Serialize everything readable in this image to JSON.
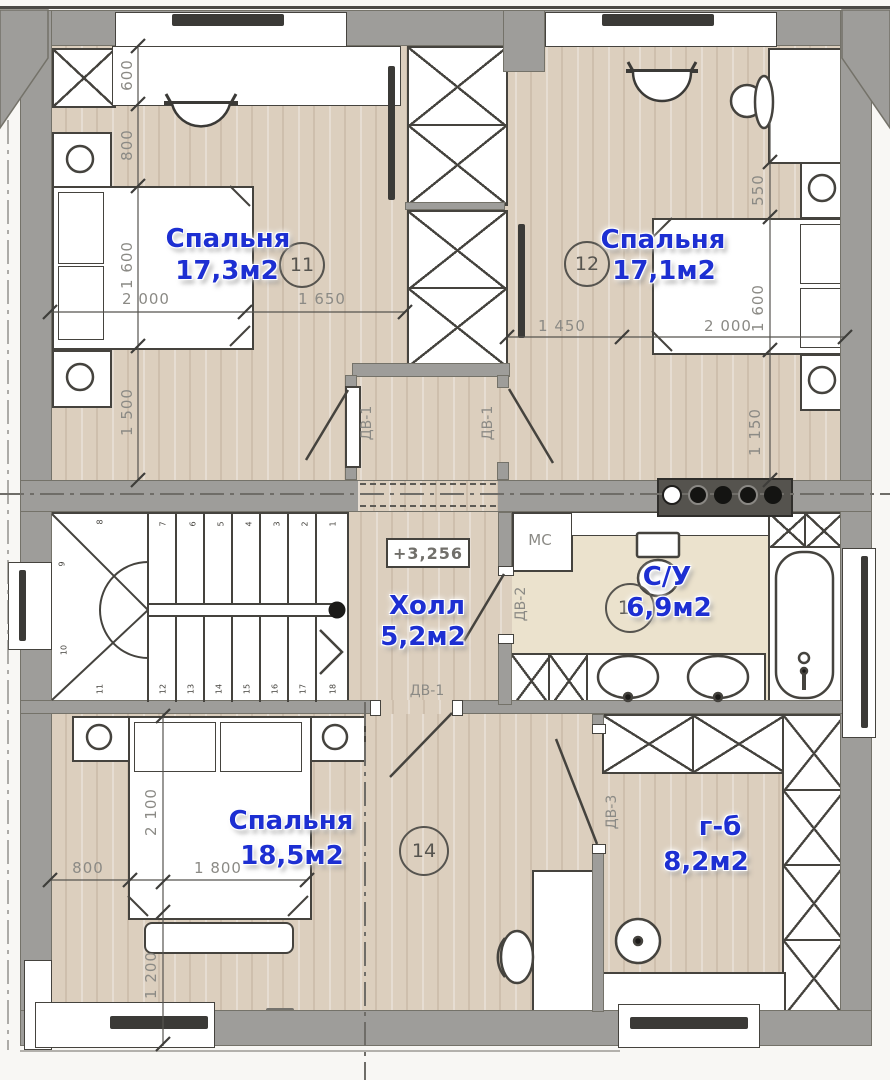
{
  "colors": {
    "accent_blue": "#1d2fd2",
    "wall_gray": "#9e9d9a",
    "floor_wood": "#dccfbe",
    "floor_tile": "#ebe2cd",
    "line_dark": "#45433e",
    "dim_gray": "#8b8a85"
  },
  "rooms": {
    "bedroom11": {
      "name": "Спальня",
      "area": "17,3м2",
      "number": "11"
    },
    "bedroom12": {
      "name": "Спальня",
      "area": "17,1м2",
      "number": "12"
    },
    "hall": {
      "name": "Холл",
      "area": "5,2м2"
    },
    "bathroom": {
      "name": "С/У",
      "area": "6,9м2",
      "number": "13"
    },
    "bedroom14": {
      "name": "Спальня",
      "area": "18,5м2",
      "number": "14"
    },
    "wardrobe": {
      "name": "г-б",
      "area": "8,2м2"
    }
  },
  "labels": {
    "elevation": "+3,256",
    "washing_machine": "МС"
  },
  "doors": {
    "dv1": "ДВ-1",
    "dv2": "ДВ-2",
    "dv3": "ДВ-3"
  },
  "dims": {
    "b11_600": "600",
    "b11_800": "800",
    "b11_1600": "1 600",
    "b11_1500": "1 500",
    "b11_2000": "2 000",
    "b11_1650": "1 650",
    "b12_1450": "1 450",
    "b12_2000": "2 000",
    "b12_550": "550",
    "b12_1600": "1 600",
    "b12_1150": "1 150",
    "b14_2100": "2 100",
    "b14_800": "800",
    "b14_1800": "1 800",
    "b14_1200": "1 200"
  },
  "stairs": {
    "numbers": [
      "1",
      "2",
      "3",
      "4",
      "5",
      "6",
      "7",
      "8",
      "9",
      "10",
      "11",
      "12",
      "13",
      "14",
      "15",
      "16",
      "17",
      "18"
    ]
  }
}
